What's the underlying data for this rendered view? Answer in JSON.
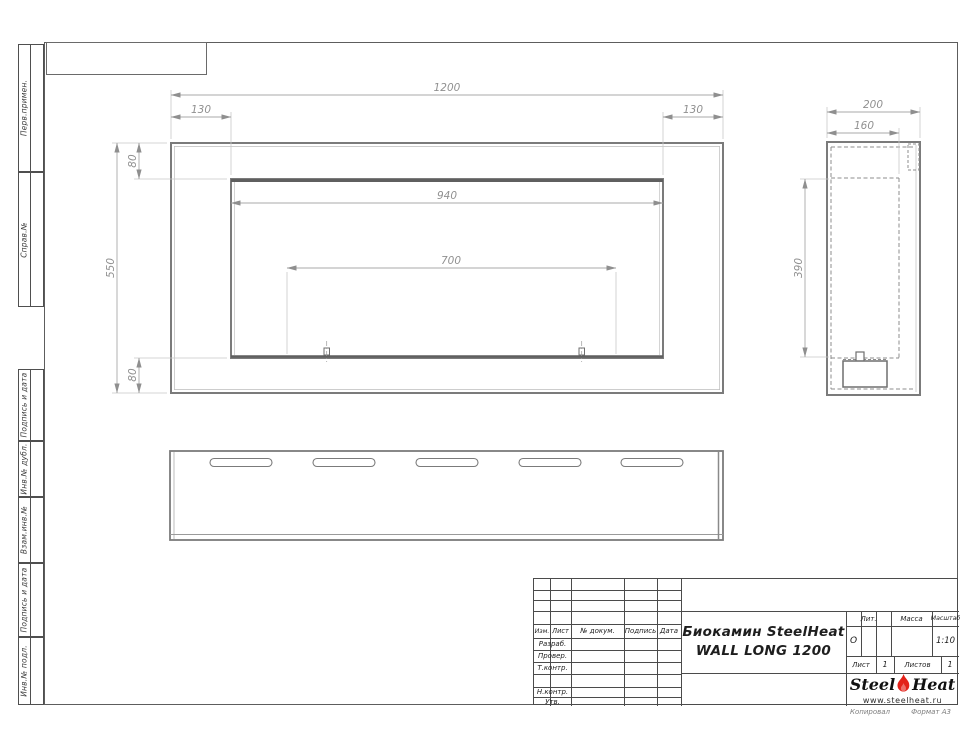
{
  "document": {
    "title_line1": "Биокамин SteelHeat",
    "title_line2": "WALL LONG 1200",
    "liter_value": "О",
    "scale_value": "1:10",
    "sheet_value": "1",
    "sheets_value": "1",
    "kopiroval": "Копировал",
    "format": "Формат А3"
  },
  "title_block": {
    "header_cols": [
      "Изм.",
      "Лист",
      "№ докум.",
      "Подпись",
      "Дата"
    ],
    "signature_rows": [
      "Разраб.",
      "Провер.",
      "Т.контр.",
      "Н.контр.",
      "Утв."
    ],
    "lit_label": "Лит.",
    "mass_label": "Масса",
    "scale_label": "Масштаб",
    "sheet_label": "Лист",
    "sheets_label": "Листов"
  },
  "margin_stamps": [
    "Перв.примен.",
    "Справ.№",
    "Подпись и дата",
    "Инв.№ дубл.",
    "Взам.инв.№",
    "Подпись и дата",
    "Инв.№ подл."
  ],
  "logo": {
    "steel": "Steel",
    "heat": "Heat",
    "site": "www.steelheat.ru",
    "flame_color": "#e32119"
  },
  "dimensions": {
    "front": {
      "width": "1200",
      "left_offset": "130",
      "right_offset": "130",
      "top_offset": "80",
      "height": "550",
      "bottom_offset": "80",
      "opening_width": "940",
      "inner_span": "700"
    },
    "side": {
      "depth": "200",
      "inner_depth": "160",
      "inner_height": "390"
    }
  },
  "colors": {
    "outline": "#7b7b7b",
    "dim_line": "#a8a8a8",
    "dim_text": "#909090",
    "accent_red": "#e32119"
  }
}
